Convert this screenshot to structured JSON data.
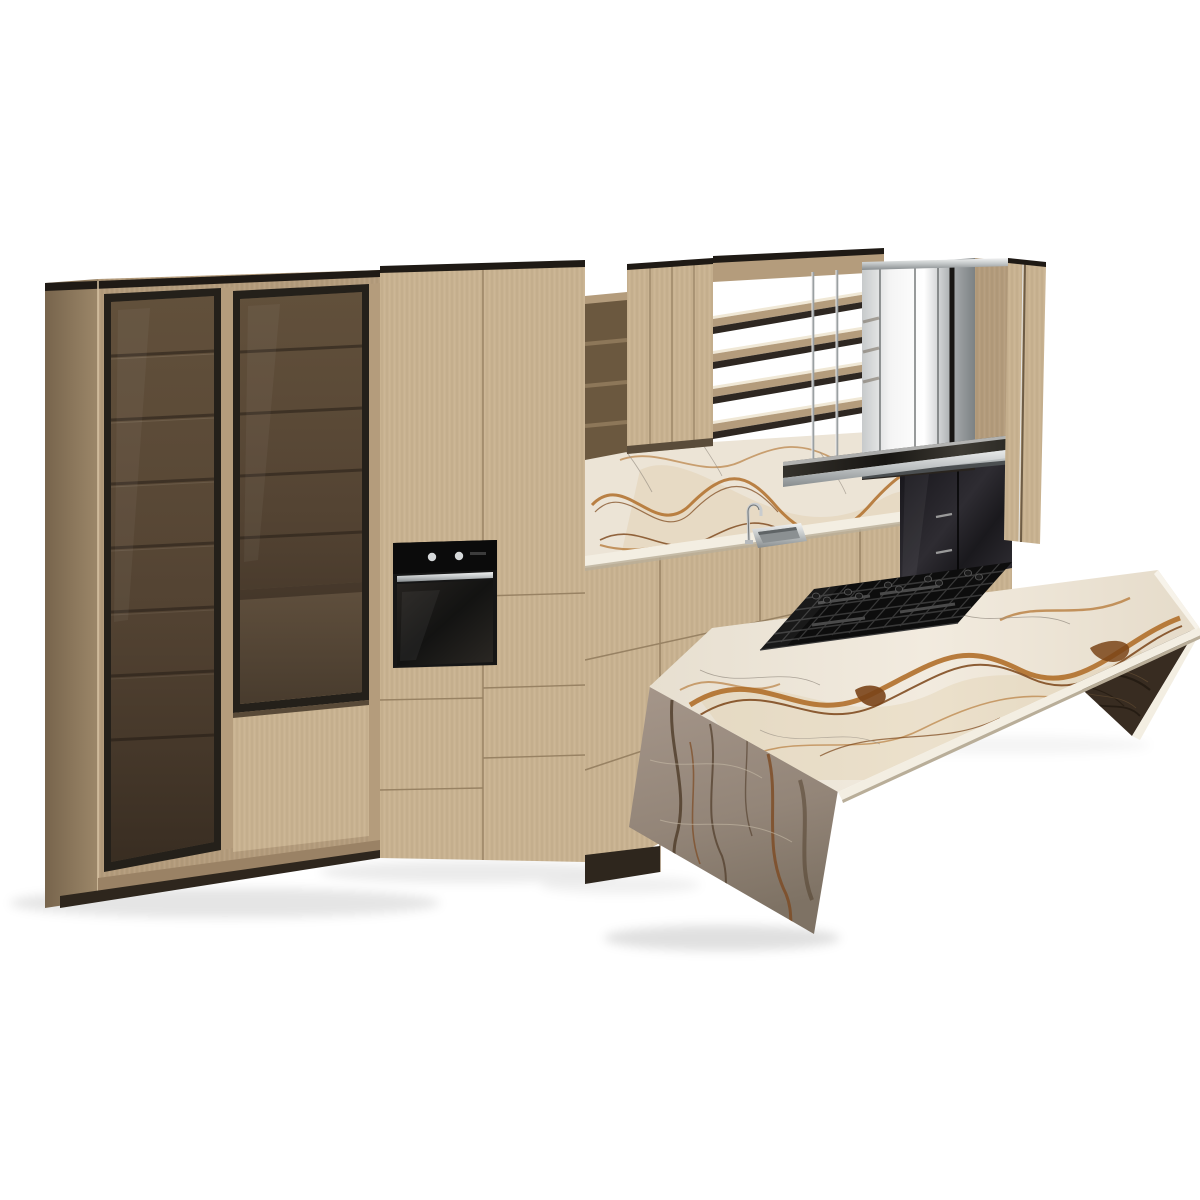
{
  "meta": {
    "title": "Modern kitchen 3D product render on white background",
    "type": "photorealistic-render",
    "background": "#ffffff"
  },
  "scene": {
    "objects": [
      {
        "name": "left-glass-cabinet",
        "label": "Tall display cabinet with two smoked-glass doors and interior shelves"
      },
      {
        "name": "tall-oven-cabinet",
        "label": "Tall oak cabinet column with built-in black oven"
      },
      {
        "name": "built-in-oven",
        "label": "Black built-in oven with steel handle and two knobs"
      },
      {
        "name": "open-cubby-shelf",
        "label": "Open cubby shelf unit"
      },
      {
        "name": "plank-wall-cabinet",
        "label": "Wall cabinet with vertical plank doors"
      },
      {
        "name": "rail-shelves",
        "label": "Open horizontal rail shelves (4 slats)"
      },
      {
        "name": "marble-backsplash",
        "label": "Gold-veined marble backsplash"
      },
      {
        "name": "counter-run",
        "label": "Marble countertop over oak drawer bases"
      },
      {
        "name": "sink",
        "label": "Inset stainless sink"
      },
      {
        "name": "faucet",
        "label": "Chrome gooseneck faucet"
      },
      {
        "name": "extractor-hood",
        "label": "Mirrored stainless extractor hood"
      },
      {
        "name": "suspended-steel-shelf",
        "label": "Steel shelf suspended on chrome rods"
      },
      {
        "name": "right-wood-panel",
        "label": "Right end oak panel"
      },
      {
        "name": "black-glass-cabinet",
        "label": "Black glass base cabinet"
      },
      {
        "name": "marble-island",
        "label": "Freestanding gold-veined marble island bench"
      },
      {
        "name": "island-left-leg",
        "label": "Slanted marble waterfall leg (shadowed)"
      },
      {
        "name": "island-right-leg",
        "label": "Dark inner face of right waterfall leg"
      },
      {
        "name": "gas-cooktop",
        "label": "Black gas cooktop with cast grates and knobs"
      },
      {
        "name": "floor-shadow",
        "label": "Soft contact shadows on white floor"
      }
    ]
  },
  "palette": {
    "bg": "#ffffff",
    "wood_light": "#c9b391",
    "wood_mid": "#b49c7c",
    "wood_deep": "#9a8265",
    "wood_side": "#8a755b",
    "wood_interior": "#6b583f",
    "wood_niche": "#a8906d",
    "frame_dark": "#24201a",
    "top_edge_dark": "#1f1a15",
    "oven_black": "#161616",
    "oven_panel": "#101010",
    "steel_light": "#eceeee",
    "steel_mid": "#b7babc",
    "steel_dark": "#6f7476",
    "shelf_top_dark": "#232019",
    "marble_base": "#ece4d6",
    "marble_edge": "#f3eee2",
    "marble_warm": "#dcc49b",
    "vein_rust": "#b06f2a",
    "vein_brown": "#7a4418",
    "crack_gray": "#9a9186",
    "leg_vein_dark": "#4e3b28",
    "leg_vein_rust": "#7d4a22",
    "leg_crack_light": "#c6baa6",
    "dark_face": "#382c21",
    "dark_face_vein": "#241b12",
    "dark_face_hilite": "#5c4730",
    "black_gloss": "#1b1a1e",
    "cooktop_black": "#0d0d0d",
    "grate_gray": "#383838",
    "knob_dark": "#1c1c1c",
    "plinth_dark": "#2e261d",
    "backdrop_dark": "#29241f"
  }
}
